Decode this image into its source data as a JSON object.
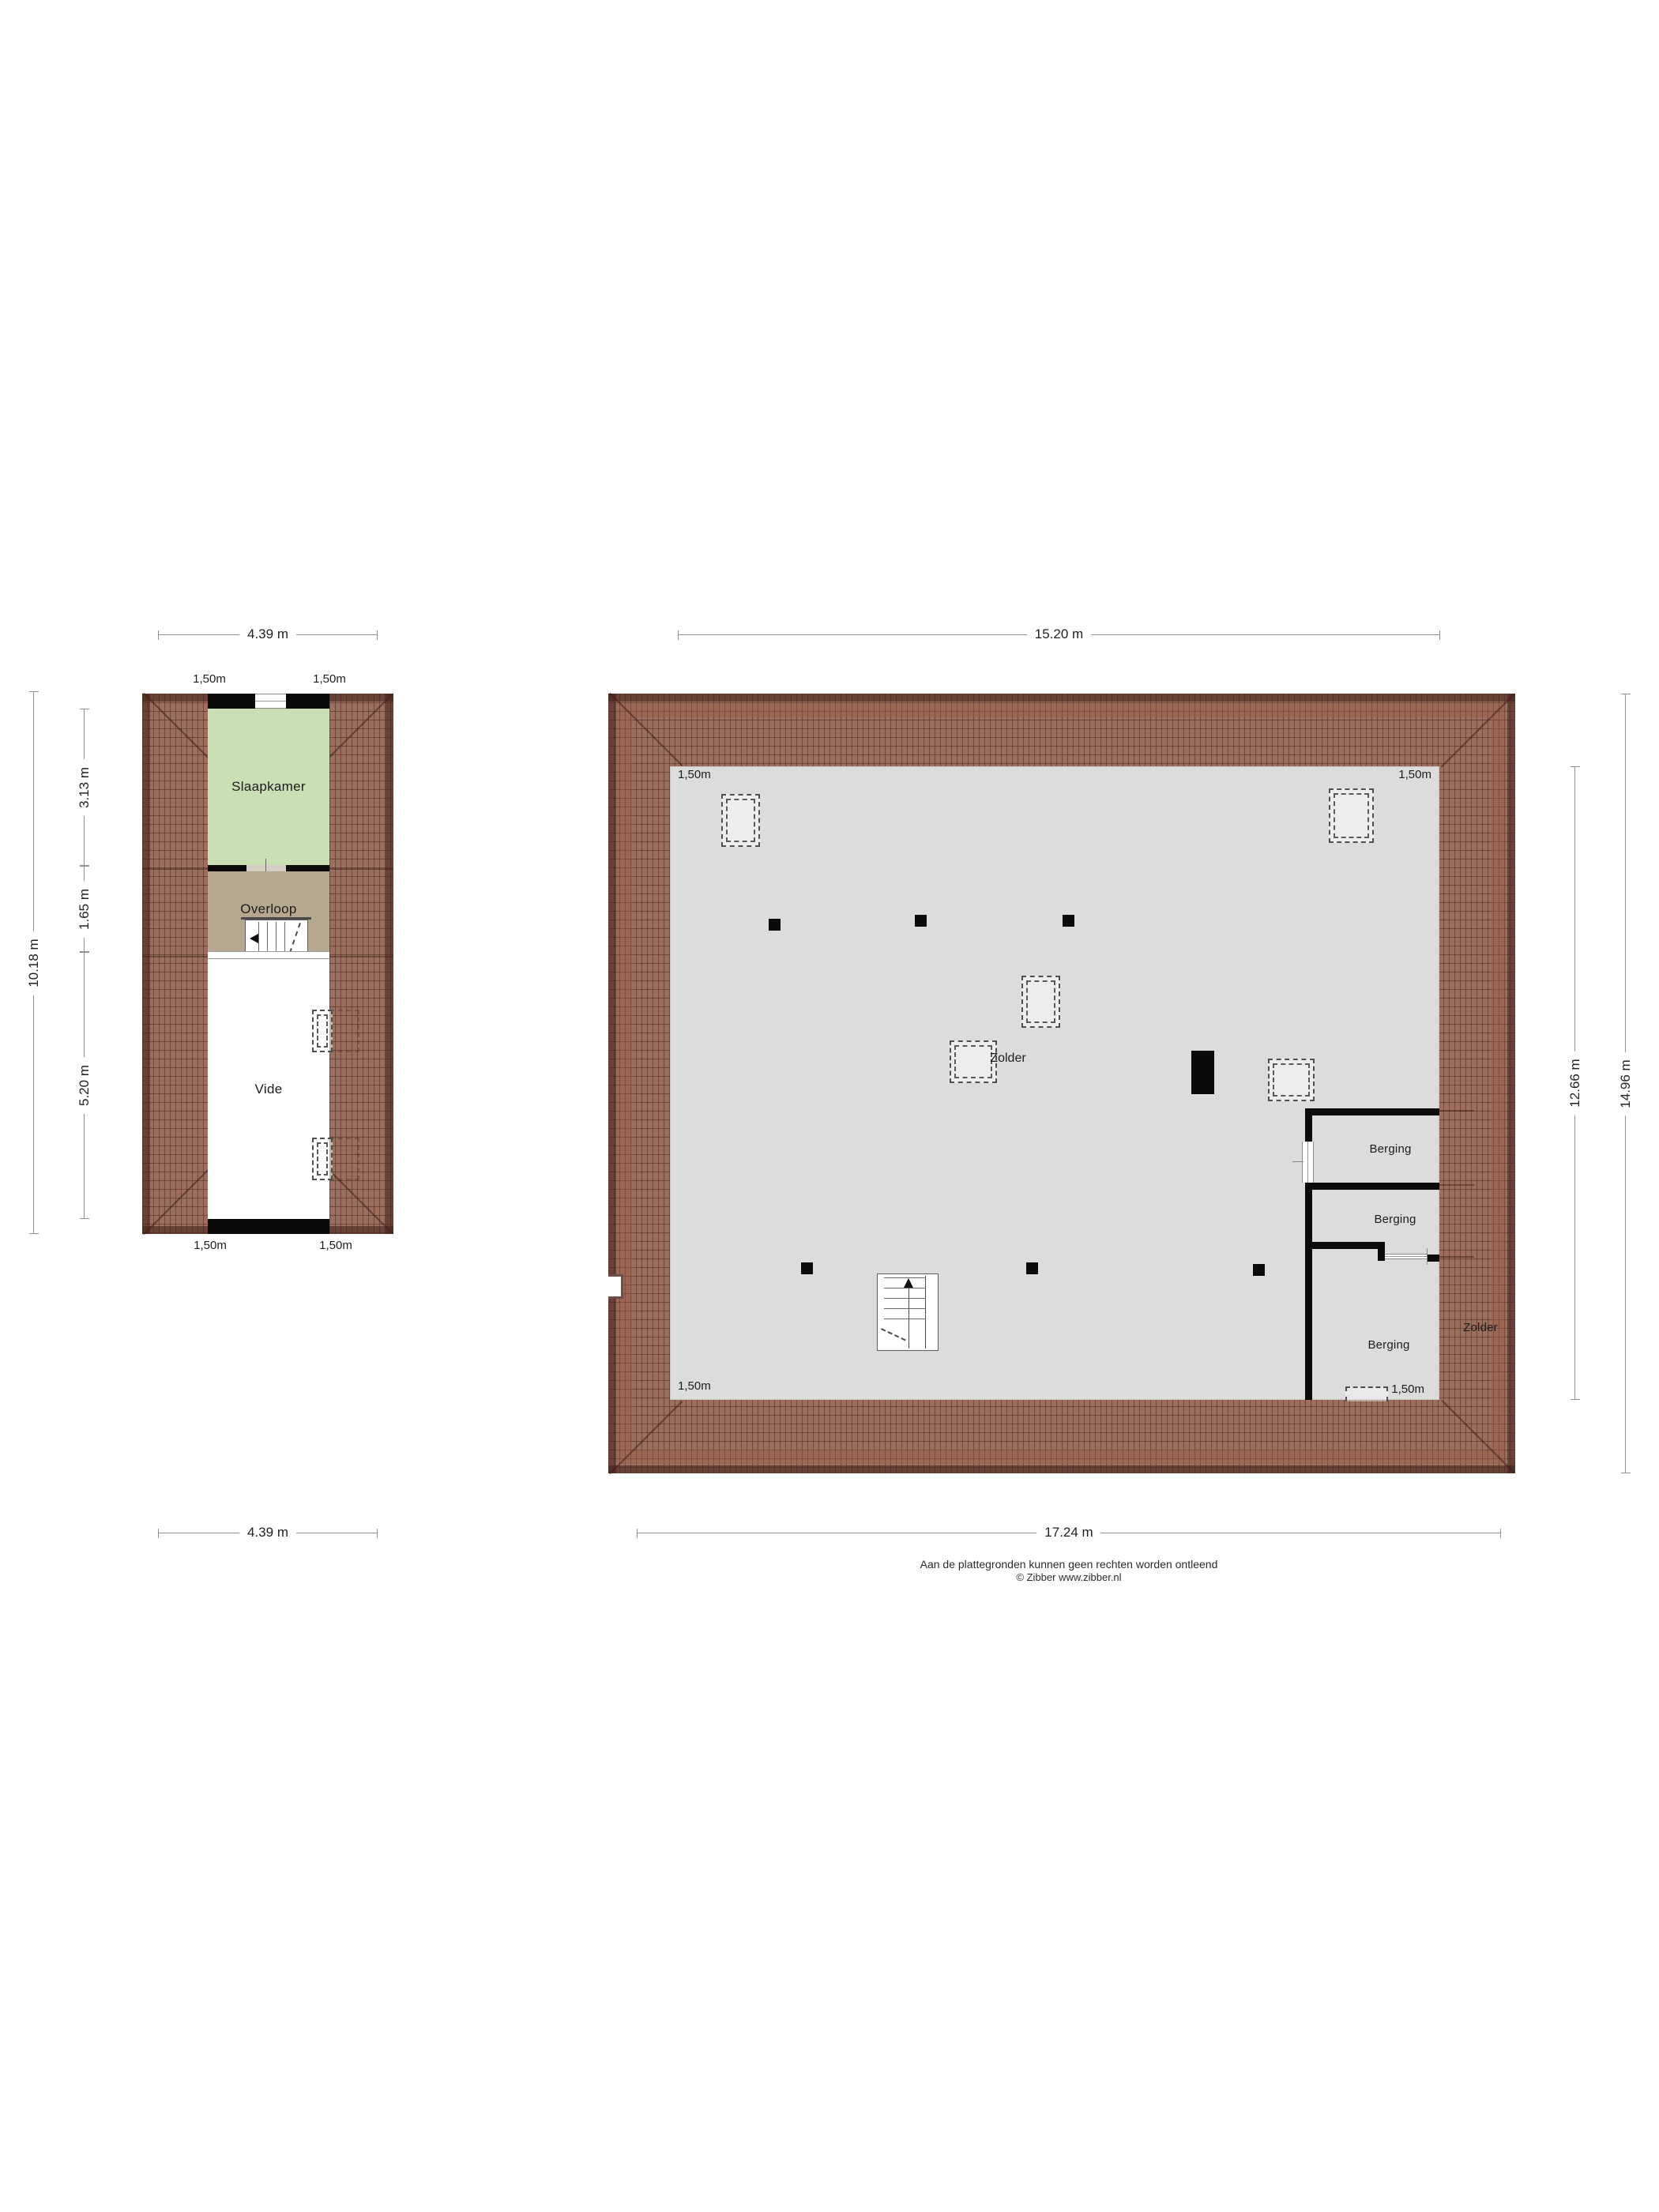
{
  "colors": {
    "roof": "#9c6e5e",
    "floor": "#dcdcda",
    "bedroom": "#c9e0b4",
    "landing": "#b6a791",
    "wall": "#0b0b0b"
  },
  "labels": {
    "clearance": "1,50m"
  },
  "small_plan": {
    "rooms": {
      "slaapkamer": "Slaapkamer",
      "overloop": "Overloop",
      "vide": "Vide"
    },
    "dims": {
      "top": "4.39 m",
      "bottom": "4.39 m",
      "left_total": "10.18 m",
      "seg_slaapkamer": "3.13 m",
      "seg_overloop": "1.65 m",
      "seg_vide": "5.20 m"
    }
  },
  "large_plan": {
    "rooms": {
      "zolder": "Zolder",
      "zolder_right": "Zolder",
      "berging1": "Berging",
      "berging2": "Berging",
      "berging3": "Berging"
    },
    "dims": {
      "top": "15.20 m",
      "bottom": "17.24 m",
      "right_inner": "12.66 m",
      "right_outer": "14.96 m"
    }
  },
  "footer": {
    "line1": "Aan de plattegronden kunnen geen rechten worden ontleend",
    "line2": "© Zibber www.zibber.nl"
  }
}
